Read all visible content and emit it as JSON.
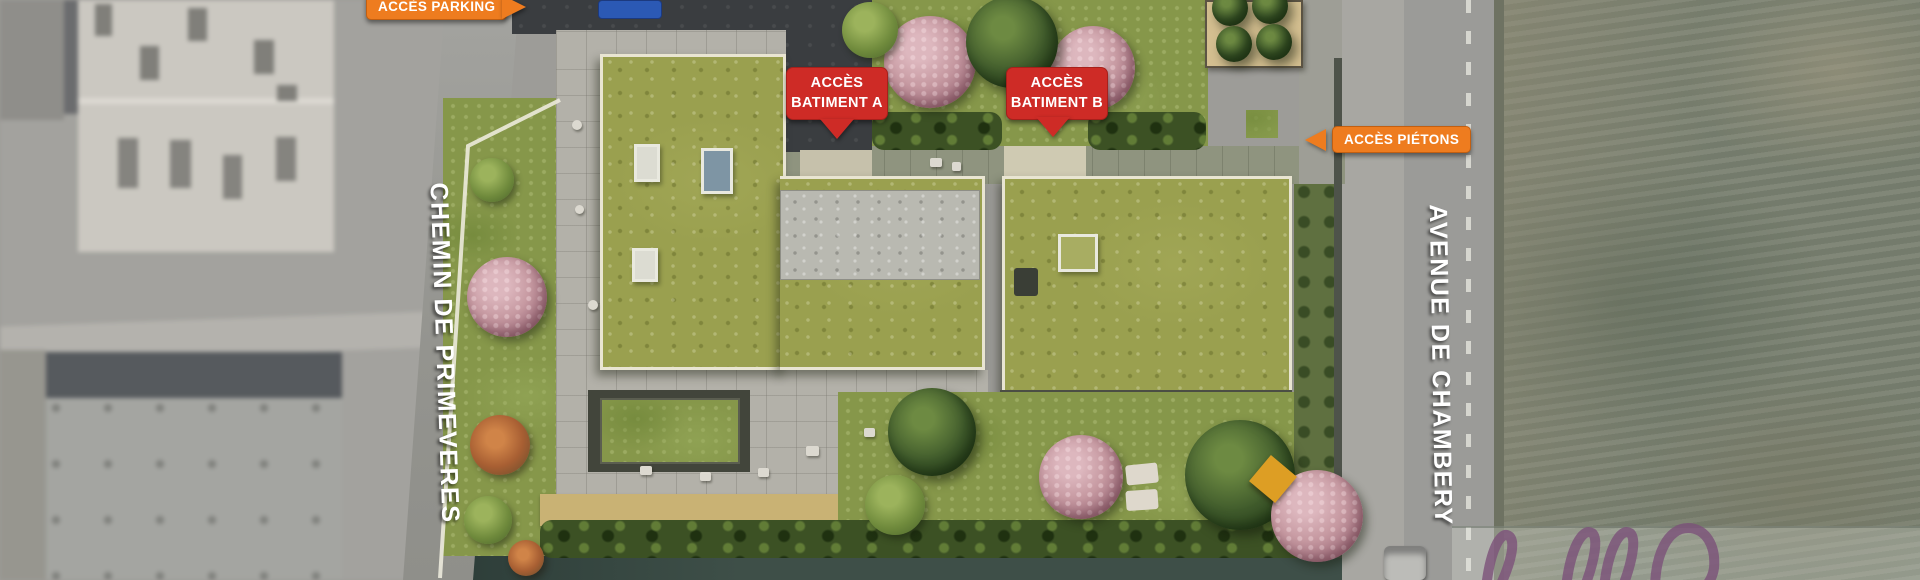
{
  "plan": {
    "access_labels": {
      "parking": "ACCÈS PARKING",
      "building_a": {
        "line1": "ACCÈS",
        "line2": "BATIMENT A"
      },
      "building_b": {
        "line1": "ACCÈS",
        "line2": "BATIMENT B"
      },
      "pedestrians": "ACCÈS PIÉTONS"
    },
    "streets": {
      "left": "CHEMIN DE PRIMEVERES",
      "right": "AVENUE DE CHAMBERY"
    },
    "icons": {
      "parking_arrow": "arrow-right-icon",
      "building_a_arrow": "arrow-down-icon",
      "building_b_arrow": "arrow-down-icon",
      "pedestrians_arrow": "arrow-left-icon",
      "signature": "signature-watermark"
    },
    "colors": {
      "access_orange": "#ee7c1f",
      "access_red": "#ce2b26",
      "label_text_white": "#ffffff",
      "street_text_white": "#ffffff",
      "green_roof": "#9aa04f",
      "lawn_green": "#86974a",
      "hedge_green": "#3c5124",
      "asphalt_dark": "#3a3d40",
      "road_gray": "#9b9b98",
      "terrace_gray": "#b3b1a9",
      "gravel_gray": "#b9b9b1",
      "parapet_cream": "#e9e5d2",
      "tan_deck": "#c9b274",
      "tan_structure": "#d4bf90",
      "pink_tree": "#c79aa2",
      "dark_tree": "#3f5a2b",
      "field_green_gray": "#7a8171",
      "bottom_road_teal": "#3e4f48",
      "car_blue": "#2b59b5",
      "parasol_yellow": "#dd9e24",
      "watermark_purple": "#7c537a"
    }
  }
}
